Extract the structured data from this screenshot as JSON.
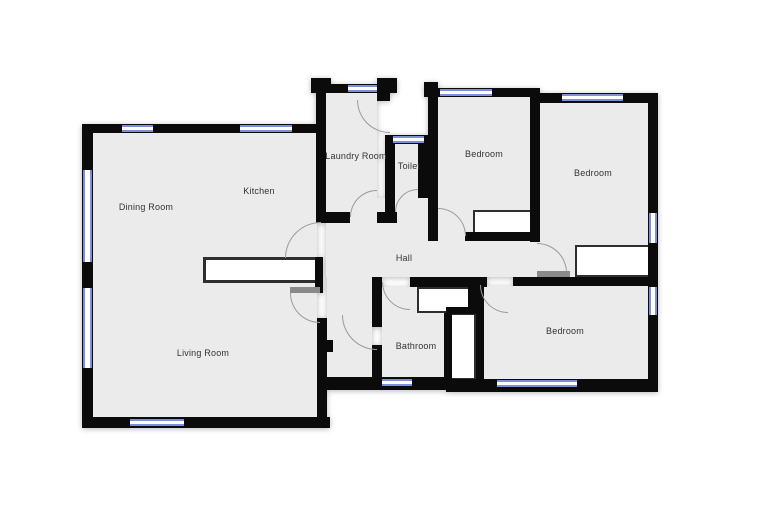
{
  "floorplan": {
    "rooms": [
      {
        "id": "dining-room",
        "label": "Dining Room"
      },
      {
        "id": "kitchen",
        "label": "Kitchen"
      },
      {
        "id": "laundry-room",
        "label": "Laundry Room"
      },
      {
        "id": "toilet",
        "label": "Toilet"
      },
      {
        "id": "bedroom-top-middle",
        "label": "Bedroom"
      },
      {
        "id": "bedroom-top-right",
        "label": "Bedroom"
      },
      {
        "id": "hall",
        "label": "Hall"
      },
      {
        "id": "living-room",
        "label": "Living Room"
      },
      {
        "id": "bathroom",
        "label": "Bathroom"
      },
      {
        "id": "bedroom-bottom-right",
        "label": "Bedroom"
      }
    ],
    "colors": {
      "wall": "#0b0b0b",
      "floor": "#ebebeb",
      "window_frame": "#7d8fd6",
      "door_arc": "#9a9a9a",
      "background": "#ffffff"
    }
  }
}
